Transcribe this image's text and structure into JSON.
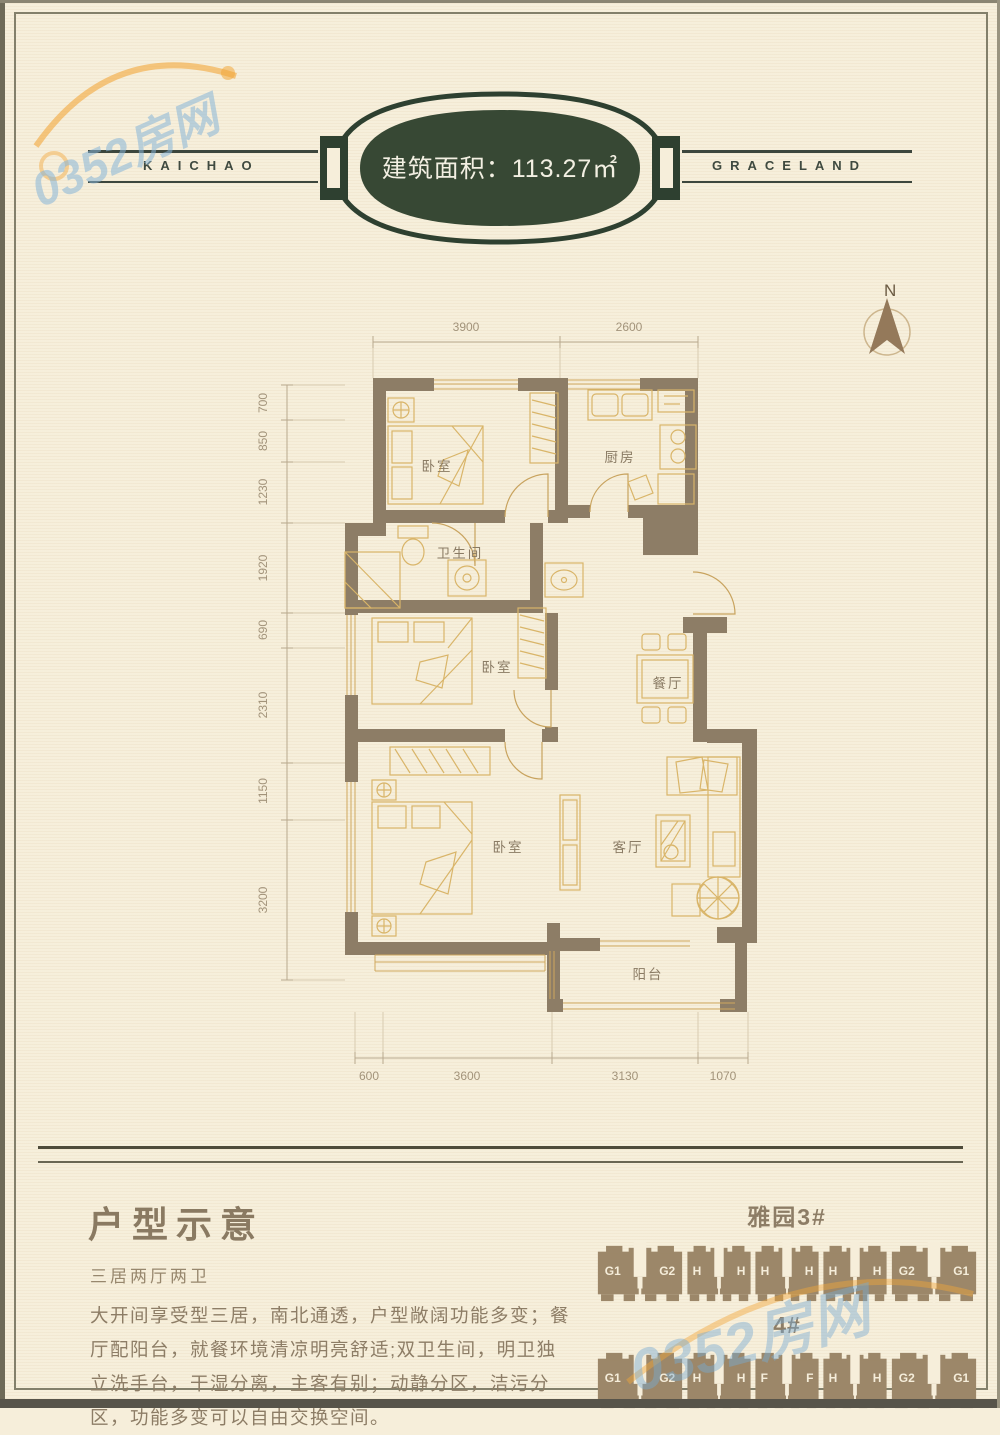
{
  "watermark": {
    "text": "0352房网"
  },
  "header": {
    "left_brand": "KAICHAO",
    "right_brand": "GRACELAND",
    "area_label": "建筑面积：113.27㎡"
  },
  "compass": {
    "label": "N"
  },
  "floorplan": {
    "labels": {
      "bedroom1": "卧室",
      "bedroom2": "卧室",
      "bedroom3": "卧室",
      "kitchen": "厨房",
      "bathroom": "卫生间",
      "dining": "餐厅",
      "living": "客厅",
      "balcony": "阳台"
    },
    "dims_top": [
      "3900",
      "2600"
    ],
    "dims_left": [
      "700",
      "850",
      "1230",
      "1920",
      "690",
      "2310",
      "1150",
      "3200"
    ],
    "dims_bottom": [
      "600",
      "3600",
      "3130",
      "1070"
    ]
  },
  "description": {
    "title": "户型示意",
    "subtitle": "三居两厅两卫",
    "body": "大开间享受型三居，南北通透，户型敞阔功能多变；餐厅配阳台，就餐环境清凉明亮舒适;双卫生间，明卫独立洗手台，干湿分离，主客有别；动静分区，洁污分区，功能多变可以自由交换空间。"
  },
  "buildings": {
    "title": "雅园3#",
    "row2_label": "4#",
    "row1": [
      {
        "left": "G1",
        "right": "G2"
      },
      {
        "left": "H",
        "right": "H"
      },
      {
        "left": "H",
        "right": "H"
      },
      {
        "left": "H",
        "right": "H"
      },
      {
        "left": "G2",
        "right": "G1"
      }
    ],
    "row2": [
      {
        "left": "G1",
        "right": "G2"
      },
      {
        "left": "H",
        "right": "H"
      },
      {
        "left": "F",
        "right": "F"
      },
      {
        "left": "H",
        "right": "H"
      },
      {
        "left": "G2",
        "right": "G1"
      }
    ]
  },
  "colors": {
    "wall": "#8d7d66",
    "furniture_line": "#d9b569",
    "badge_green": "#374834",
    "building_block": "#9c8769",
    "watermark_blue": "#87b4d7",
    "watermark_orange": "#f2a73a",
    "paper": "#f6eeda"
  }
}
